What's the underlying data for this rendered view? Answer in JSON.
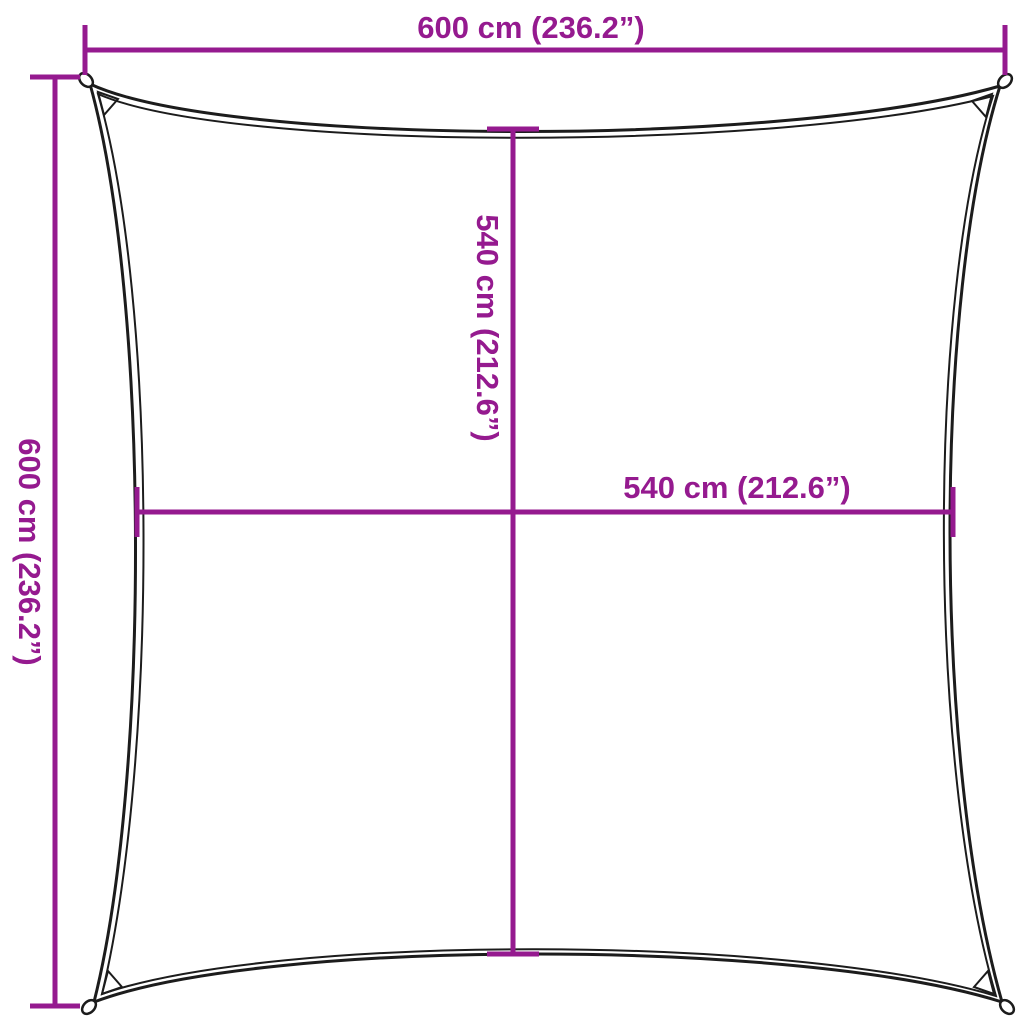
{
  "figure": {
    "kind": "product-dimension-diagram",
    "subject": "square shade sail outline with concave edges and corner grommets"
  },
  "colors": {
    "accent": "#951a8f",
    "outline": "#1c1c1c",
    "background": "#ffffff"
  },
  "labels": {
    "outer_width": "600 cm (236.2”)",
    "outer_height": "600 cm (236.2”)",
    "inner_height": "540 cm (212.6”)",
    "inner_width": "540 cm (212.6”)"
  },
  "values": {
    "outer_width_cm": 600,
    "outer_width_in": 236.2,
    "outer_height_cm": 600,
    "outer_height_in": 236.2,
    "inner_width_cm": 540,
    "inner_width_in": 212.6,
    "inner_height_cm": 540,
    "inner_height_in": 212.6
  }
}
